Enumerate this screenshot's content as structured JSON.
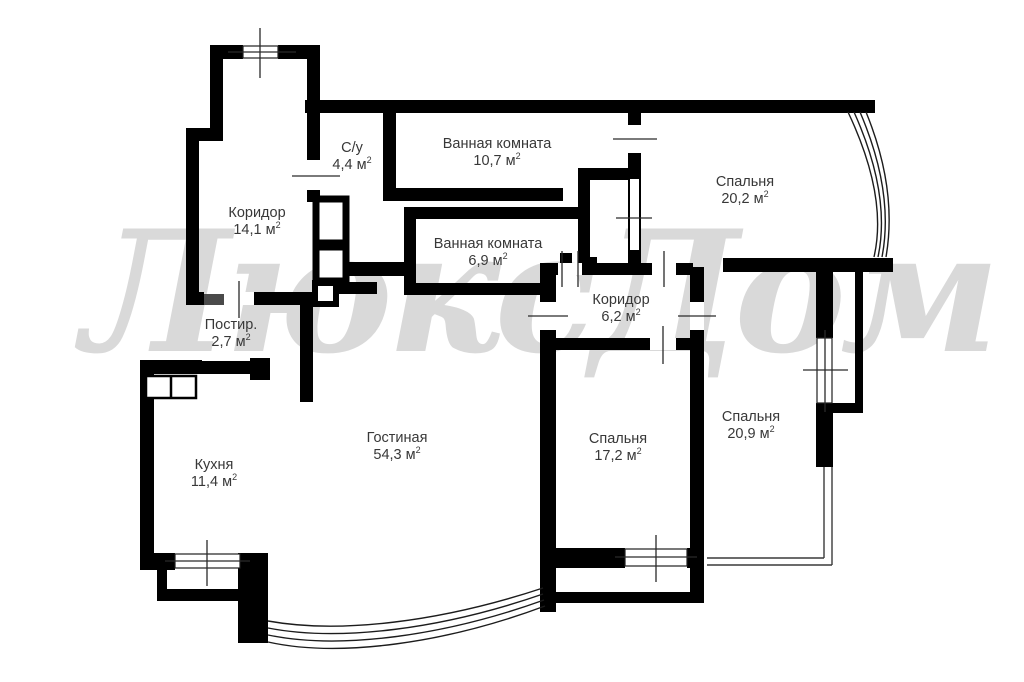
{
  "watermark": {
    "text": "ЛюксДом"
  },
  "units": {
    "area_unit": "м",
    "area_sup": "2"
  },
  "rooms": [
    {
      "name": "Коридор",
      "area": "14,1"
    },
    {
      "name": "С/у",
      "area": "4,4"
    },
    {
      "name": "Ванная комната",
      "area": "10,7"
    },
    {
      "name": "Спальня",
      "area": "20,2"
    },
    {
      "name": "Ванная комната",
      "area": "6,9"
    },
    {
      "name": "Коридор",
      "area": "6,2"
    },
    {
      "name": "Постир.",
      "area": "2,7"
    },
    {
      "name": "Кухня",
      "area": "11,4"
    },
    {
      "name": "Гостиная",
      "area": "54,3"
    },
    {
      "name": "Спальня",
      "area": "17,2"
    },
    {
      "name": "Спальня",
      "area": "20,9"
    }
  ],
  "colors": {
    "wall": "#000000",
    "tick": "#2a2a2a",
    "watermark": "#d9d9d9",
    "label": "#383838",
    "door_leaf": "#4a4a4a"
  }
}
